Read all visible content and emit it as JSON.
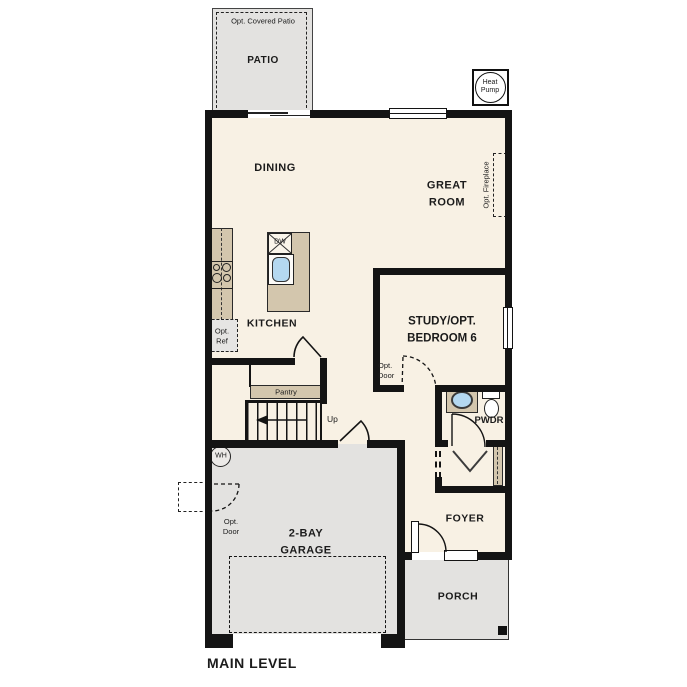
{
  "title": "MAIN LEVEL",
  "rooms": {
    "patio": "PATIO",
    "dining": "DINING",
    "great_room": "GREAT\nROOM",
    "kitchen": "KITCHEN",
    "study": "STUDY/OPT.\nBEDROOM 6",
    "powder": "PWDR",
    "foyer": "FOYER",
    "garage": "2-BAY\nGARAGE",
    "porch": "PORCH"
  },
  "annotations": {
    "opt_covered_patio": "Opt. Covered Patio",
    "heat_pump": "Heat\nPump",
    "opt_fireplace": "Opt. Fireplace",
    "dishwasher": "DW",
    "opt_ref": "Opt.\nRef",
    "opt_door": "Opt.\nDoor",
    "pantry": "Pantry",
    "up": "Up",
    "water_heater": "WH"
  },
  "colors": {
    "floor": "#f8f1e4",
    "outdoor": "#e3e2e0",
    "casework": "#d3c6ad",
    "fixture_blue": "#b4d8f0",
    "wall": "#141414"
  }
}
